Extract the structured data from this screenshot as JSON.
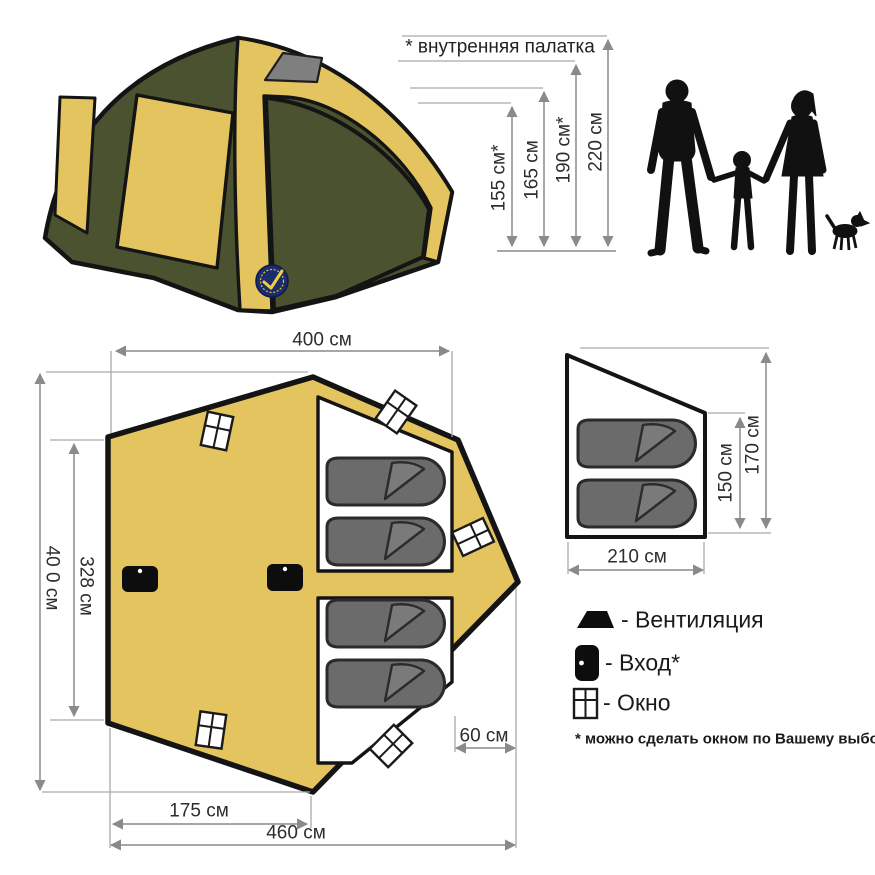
{
  "elevation": {
    "note": "* внутренняя палатка",
    "heights": {
      "h1": "155 см*",
      "h2": "165 см",
      "h3": "190 см*",
      "h4": "220 см"
    }
  },
  "floor_plan": {
    "top_width": "400 см",
    "left_height": "40 0 см",
    "inner_height": "328 см",
    "front_width": "175 см",
    "total_width": "460 см",
    "porch_depth": "60 см"
  },
  "inner_tent_section": {
    "width": "210 см",
    "inner_height": "150 см",
    "height": "170 см"
  },
  "legend": {
    "vent": "- Вентиляция",
    "door": "- Вход*",
    "window": "- Окно",
    "footnote": "* можно сделать окном по Вашему выбору"
  },
  "icons": {
    "vent": "vent-icon",
    "door": "entrance-icon",
    "window": "window-icon",
    "logo": "brand-logo"
  },
  "colors": {
    "tent_yellow": "#e3c45f",
    "tent_olive": "#4a5230",
    "outline_black": "#141414",
    "bag_gray": "#6b6b6b",
    "vent_gray": "#7f7f7f",
    "dimension_gray": "#8a8a8a",
    "silhouette_black": "#111111",
    "logo_navy": "#1c2d6e"
  }
}
